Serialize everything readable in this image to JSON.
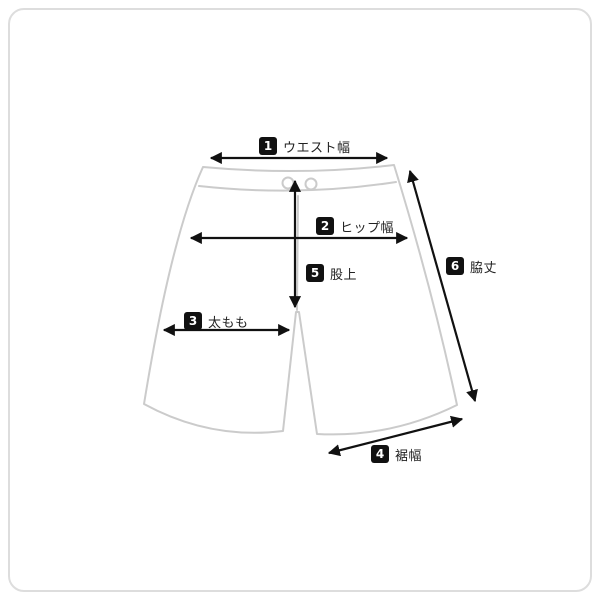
{
  "colors": {
    "frame_border": "#dddddd",
    "outline": "#cbcbcb",
    "arrow": "#111111",
    "badge": "#111111",
    "text": "#222222"
  },
  "diagram": {
    "labels": [
      {
        "number": "1",
        "text": "ウエスト幅"
      },
      {
        "number": "2",
        "text": "ヒップ幅"
      },
      {
        "number": "3",
        "text": "太もも"
      },
      {
        "number": "4",
        "text": "裾幅"
      },
      {
        "number": "5",
        "text": "股上"
      },
      {
        "number": "6",
        "text": "脇丈"
      }
    ]
  }
}
